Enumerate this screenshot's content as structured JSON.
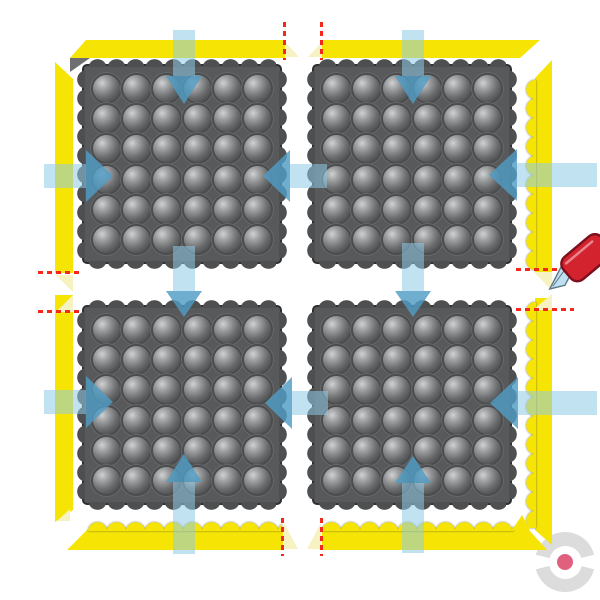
{
  "diagram": {
    "description": "Assembly diagram of four interlocking modular anti-fatigue mat tiles (bubble dome surface) framed by yellow beveled safety ramps; blue arrows show interlocking directions, red dashed lines mark ramp cut points, a utility knife shows where to trim the beveled ramp ends.",
    "canvas": {
      "width": 600,
      "height": 600,
      "background": "#ffffff"
    }
  },
  "colors": {
    "mat_body": "#58595b",
    "mat_border": "#2e2f31",
    "mat_bump": "#4e4f51",
    "dome_highlight": "#cfd1d3",
    "dome_mid": "#6b6d6f",
    "dome_dark": "#3f4143",
    "dome_ring": "#4b4c4e",
    "ramp_yellow": "#f6e404",
    "ramp_bevel": "#f7f2c2",
    "ramp_endface": "#6f6f71",
    "arrow_shaft": "rgba(142,202,230,0.55)",
    "arrow_head": "rgba(80,156,196,0.82)",
    "cut_line": "#f3281a",
    "knife_handle": "#d2232f",
    "knife_handle_dark": "#7e0f1c",
    "knife_blade": "#bfe0f2",
    "knife_blade_edge": "#5f7683",
    "logo_ring": "#dcdcdc",
    "logo_dot": "#e0617e"
  },
  "mats": {
    "count": 4,
    "tile_size": 200,
    "dome_rows": 6,
    "dome_cols": 6,
    "tiles": [
      {
        "id": "mat-1",
        "x": 82,
        "y": 64
      },
      {
        "id": "mat-2",
        "x": 312,
        "y": 64
      },
      {
        "id": "mat-3",
        "x": 82,
        "y": 305
      },
      {
        "id": "mat-4",
        "x": 312,
        "y": 305
      }
    ]
  },
  "ramps": {
    "bodies": [
      {
        "id": "ramp-top-left",
        "x": 70,
        "y": 40,
        "w": 215,
        "h": 18,
        "clip": "16,0 215,0 215,18 0,18"
      },
      {
        "id": "ramp-top-right",
        "x": 322,
        "y": 40,
        "w": 218,
        "h": 18,
        "clip": "0,0 218,0 198,18 0,18"
      },
      {
        "id": "ramp-left-upper",
        "x": 55,
        "y": 62,
        "w": 18,
        "h": 211,
        "clip": "0,0 18,17 18,211 0,211"
      },
      {
        "id": "ramp-left-lower",
        "x": 55,
        "y": 295,
        "w": 18,
        "h": 227,
        "clip": "0,0 18,0 18,215 0,227"
      },
      {
        "id": "ramp-right-upper",
        "x": 535,
        "y": 60,
        "w": 17,
        "h": 212,
        "clip": "0,18 17,0 17,212 0,212"
      },
      {
        "id": "ramp-right-lower",
        "x": 535,
        "y": 298,
        "w": 17,
        "h": 247,
        "clip": "0,0 17,0 17,247 0,232"
      },
      {
        "id": "ramp-bottom-left",
        "x": 67,
        "y": 530,
        "w": 216,
        "h": 20,
        "clip": "20,0 216,0 216,20 0,20"
      },
      {
        "id": "ramp-bottom-right",
        "x": 322,
        "y": 530,
        "w": 225,
        "h": 20,
        "clip": "0,0 207,0 225,20 0,20"
      }
    ],
    "scallops": [
      {
        "id": "scallop-right-upper",
        "x": 526,
        "y": 80,
        "w": 10,
        "h": 190,
        "dir": "left"
      },
      {
        "id": "scallop-right-lower",
        "x": 526,
        "y": 302,
        "w": 10,
        "h": 226,
        "dir": "left"
      },
      {
        "id": "scallop-bottom-left",
        "x": 88,
        "y": 522,
        "w": 194,
        "h": 9,
        "dir": "up"
      },
      {
        "id": "scallop-bottom-right",
        "x": 322,
        "y": 522,
        "w": 192,
        "h": 9,
        "dir": "up"
      }
    ],
    "bevel_caps": [
      "285,42 299,57 285,57",
      "322,42 322,57 308,57",
      "284,523 298,549 284,549",
      "321,523 321,549 307,549",
      "56,275 73,275 73,292",
      "56,312 73,295 73,312",
      "534,272 552,272 552,291",
      "533,310 552,294 552,310",
      "57,521 70,509 70,521"
    ],
    "corner_faces": [
      {
        "points": "70,58 90,58 70,72",
        "fill": "endface"
      },
      {
        "points": "512,530 530,530 522,515",
        "fill": "yellow"
      }
    ]
  },
  "arrow_metrics": {
    "v_shaft_w": 22,
    "v_head_w": 36,
    "h_shaft_h": 24,
    "h_head_h": 52
  },
  "arrows": [
    {
      "id": "arrow-down-into-mat1",
      "dir": "down",
      "cx": 184,
      "shaft": [
        30,
        76
      ],
      "head": [
        76,
        104
      ]
    },
    {
      "id": "arrow-down-into-mat2",
      "dir": "down",
      "cx": 413,
      "shaft": [
        30,
        76
      ],
      "head": [
        76,
        104
      ]
    },
    {
      "id": "arrow-right-into-mat1",
      "dir": "right",
      "cy": 176,
      "shaft": [
        44,
        86
      ],
      "head": [
        86,
        113
      ]
    },
    {
      "id": "arrow-left-into-mat1",
      "dir": "left",
      "cy": 176,
      "shaft": [
        290,
        327
      ],
      "head": [
        263,
        290
      ]
    },
    {
      "id": "arrow-left-into-mat2",
      "dir": "left",
      "cy": 175,
      "shaft": [
        517,
        597
      ],
      "head": [
        489,
        517
      ]
    },
    {
      "id": "arrow-down-into-mat3",
      "dir": "down",
      "cx": 184,
      "shaft": [
        246,
        291
      ],
      "head": [
        291,
        317
      ]
    },
    {
      "id": "arrow-down-into-mat4",
      "dir": "down",
      "cx": 413,
      "shaft": [
        243,
        291
      ],
      "head": [
        291,
        317
      ]
    },
    {
      "id": "arrow-right-into-mat3",
      "dir": "right",
      "cy": 402,
      "shaft": [
        44,
        86
      ],
      "head": [
        86,
        113
      ]
    },
    {
      "id": "arrow-left-into-mat3",
      "dir": "left",
      "cy": 403,
      "shaft": [
        292,
        328
      ],
      "head": [
        265,
        292
      ]
    },
    {
      "id": "arrow-left-into-mat4",
      "dir": "left",
      "cy": 403,
      "shaft": [
        518,
        597
      ],
      "head": [
        490,
        518
      ]
    },
    {
      "id": "arrow-up-into-mat3",
      "dir": "up",
      "cx": 184,
      "shaft": [
        482,
        554
      ],
      "head": [
        454,
        482
      ]
    },
    {
      "id": "arrow-up-into-mat4",
      "dir": "up",
      "cx": 413,
      "shaft": [
        483,
        553
      ],
      "head": [
        456,
        483
      ]
    }
  ],
  "cut_lines": [
    {
      "id": "cut-top-left-ramp",
      "orient": "v",
      "x": 283,
      "y": 22,
      "len": 38
    },
    {
      "id": "cut-top-right-ramp",
      "orient": "v",
      "x": 320,
      "y": 22,
      "len": 38
    },
    {
      "id": "cut-bottom-left-ramp",
      "orient": "v",
      "x": 281,
      "y": 518,
      "len": 38
    },
    {
      "id": "cut-bottom-right-ramp",
      "orient": "v",
      "x": 320,
      "y": 518,
      "len": 38
    },
    {
      "id": "cut-left-upper-ramp",
      "orient": "h",
      "x": 38,
      "y": 271,
      "len": 44
    },
    {
      "id": "cut-left-lower-ramp",
      "orient": "h",
      "x": 38,
      "y": 310,
      "len": 44
    },
    {
      "id": "cut-right-upper-ramp",
      "orient": "h",
      "x": 516,
      "y": 268,
      "len": 41
    },
    {
      "id": "cut-right-lower-ramp",
      "orient": "h",
      "x": 516,
      "y": 308,
      "len": 58
    }
  ],
  "knife": {
    "id": "utility-knife",
    "tip_x": 552,
    "tip_y": 298
  },
  "logo": {
    "cx": 565,
    "cy": 562,
    "outer_d": 60,
    "inner_d": 33,
    "dot_d": 16,
    "gap_deg": 28
  }
}
